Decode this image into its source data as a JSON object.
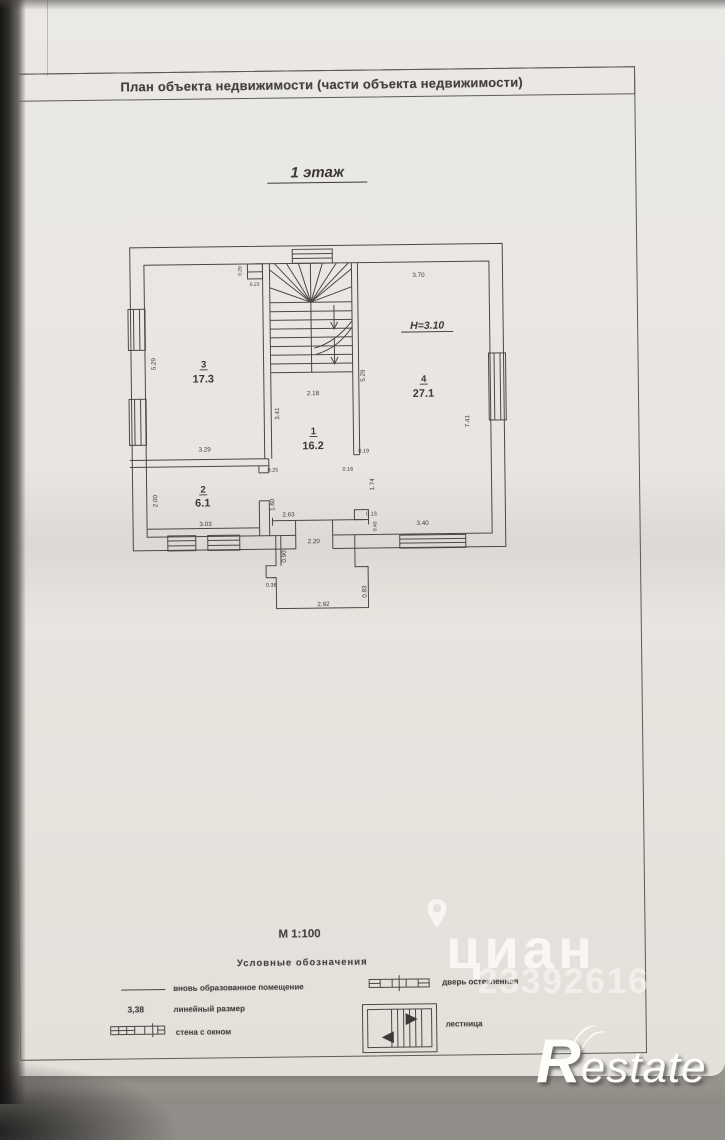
{
  "header": {
    "title": "План объекта недвижимости (части объекта недвижимости)"
  },
  "floor_label": "1 этаж",
  "plan": {
    "height_note": "H=3.10",
    "rooms": {
      "r1": {
        "num": "1",
        "area": "16.2"
      },
      "r2": {
        "num": "2",
        "area": "6.1"
      },
      "r3": {
        "num": "3",
        "area": "17.3"
      },
      "r4": {
        "num": "4",
        "area": "27.1"
      }
    },
    "dims": {
      "room4_top": "3.70",
      "room4_right": "7.41",
      "stair_right": "5.29",
      "room3_left": "5.29",
      "room1_top": "2.18",
      "room1_left": "3.41",
      "room3_bottom": "3.29",
      "tick_025": "0.25",
      "door_160": "1.60",
      "room2_left": "2.00",
      "room2_bottom": "3.03",
      "tick_019": "0.19",
      "tick_016": "0.16",
      "door_174": "1.74",
      "tick_013": "0.13",
      "tick_040": "0.40",
      "door_263": "2.63",
      "door_220": "2.20",
      "porch_090": "0.90",
      "porch_036": "0.36",
      "porch_bottom": "2.92",
      "porch_083": "0.83",
      "window_340": "3.40",
      "stair_029": "0.29",
      "stair_023": "0.23"
    }
  },
  "legend": {
    "scale": "М 1:100",
    "title": "Условные обозначения",
    "items": {
      "new_premises": "вновь образованное помещение",
      "linear_value": "3,38",
      "linear": "линейный размер",
      "wall_window": "стена с окном",
      "glazed_door": "дверь остекленная",
      "stairs": "лестница"
    }
  },
  "watermarks": {
    "brand": "циан",
    "digits": "23392616",
    "agency_r": "R",
    "agency_rest": "estate"
  },
  "colors": {
    "paper": "#e9e6e1",
    "ink": "#4a4846",
    "photo_bg": "#918e89"
  }
}
